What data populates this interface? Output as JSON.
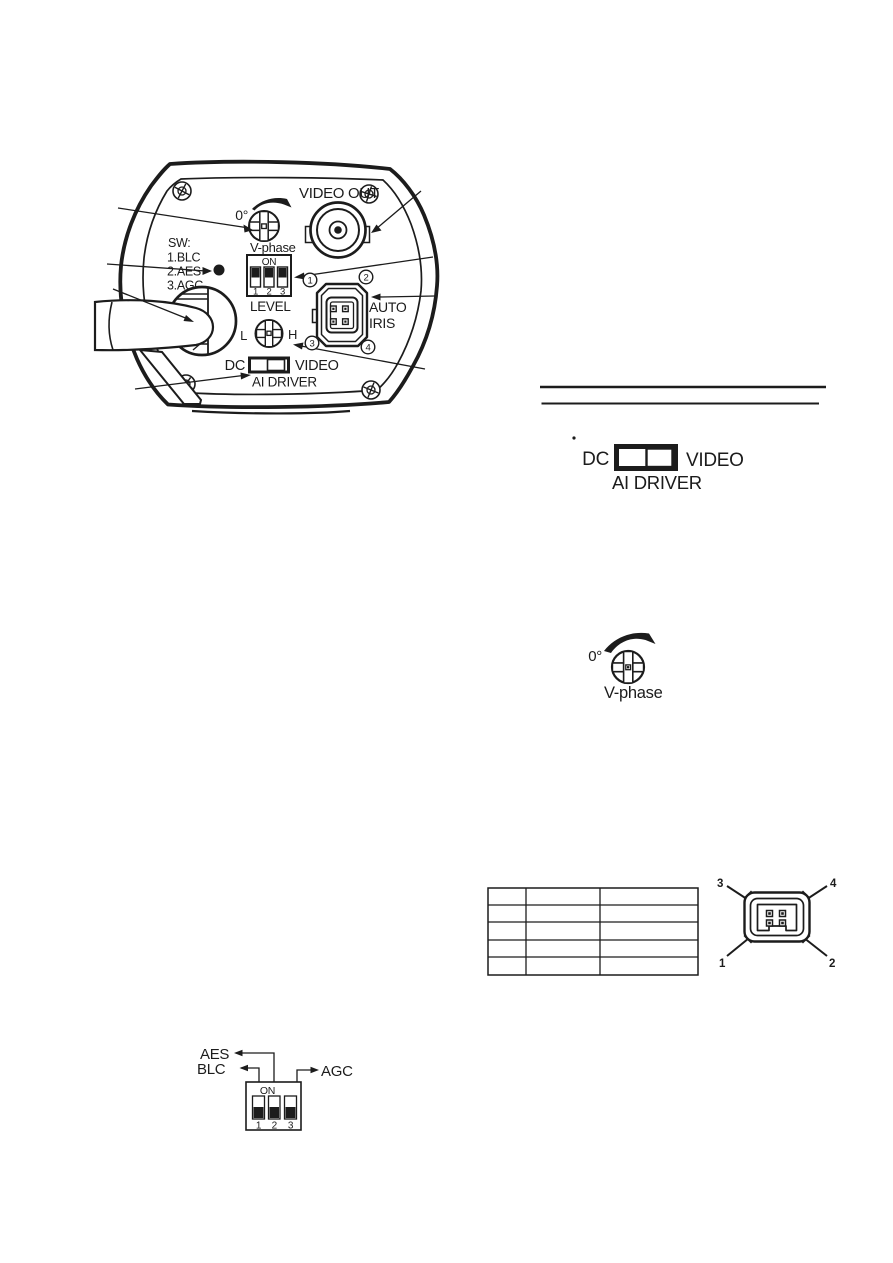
{
  "colors": {
    "ink": "#1c1c1c",
    "paper": "#ffffff"
  },
  "figure": {
    "panel": {
      "video_out": "VIDEO OUT",
      "deg": "0°",
      "v_phase": "V-phase",
      "sw": "SW:",
      "sw1": "1.BLC",
      "sw2": "2.AES",
      "sw3": "3.AGC",
      "on": "ON",
      "d1": "1",
      "d2": "2",
      "d3": "3",
      "level": "LEVEL",
      "l": "L",
      "h": "H",
      "auto": "AUTO",
      "iris": "IRIS",
      "dc": "DC",
      "video": "VIDEO",
      "ai_driver": "AI DRIVER",
      "p1": "1",
      "p2": "2",
      "p3": "3",
      "p4": "4"
    },
    "switch_diagram": {
      "dc": "DC",
      "video": "VIDEO",
      "ai_driver": "AI DRIVER"
    },
    "vphase_diagram": {
      "deg": "0°",
      "v_phase": "V-phase"
    },
    "pin_table": {
      "rows": 5,
      "columns": 3,
      "cells": [
        [
          "",
          "",
          ""
        ],
        [
          "",
          "",
          ""
        ],
        [
          "",
          "",
          ""
        ],
        [
          "",
          "",
          ""
        ],
        [
          "",
          "",
          ""
        ]
      ]
    },
    "connector_diagram": {
      "n1": "1",
      "n2": "2",
      "n3": "3",
      "n4": "4"
    },
    "dip_diagram": {
      "aes": "AES",
      "blc": "BLC",
      "agc": "AGC",
      "on": "ON",
      "n1": "1",
      "n2": "2",
      "n3": "3"
    }
  }
}
